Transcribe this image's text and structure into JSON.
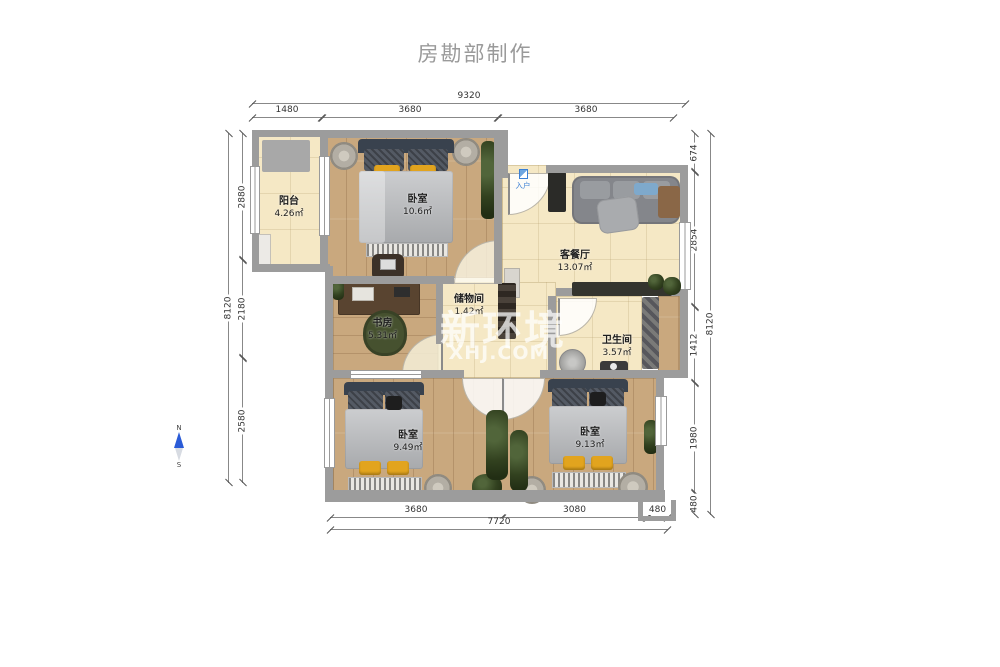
{
  "title": "房勘部制作",
  "watermark": {
    "brand": "新环境",
    "site": "XHJ.COM"
  },
  "compass": {
    "north": "N",
    "south": "S"
  },
  "entrance": {
    "label": "入户"
  },
  "rooms": [
    {
      "name": "阳台",
      "area": "4.26㎡"
    },
    {
      "name": "卧室",
      "area": "10.6㎡"
    },
    {
      "name": "客餐厅",
      "area": "13.07㎡"
    },
    {
      "name": "书房",
      "area": "5.31㎡"
    },
    {
      "name": "储物间",
      "area": "1.42㎡"
    },
    {
      "name": "卫生间",
      "area": "3.57㎡"
    },
    {
      "name": "卧室",
      "area": "9.49㎡"
    },
    {
      "name": "卧室",
      "area": "9.13㎡"
    }
  ],
  "dimensions": {
    "top": {
      "total": "9320",
      "segments": [
        "1480",
        "3680",
        "3680"
      ]
    },
    "bottom": {
      "total": "7720",
      "segments": [
        "3680",
        "3080",
        "480"
      ]
    },
    "left": {
      "total": "8120",
      "segments": [
        "2880",
        "2180",
        "2580"
      ]
    },
    "right": {
      "total": "8120",
      "segments": [
        "674",
        "2854",
        "1412",
        "1980",
        "480"
      ]
    }
  },
  "colors": {
    "wall": "#9c9c9c",
    "wood_floor": "#c9a87e",
    "tile_floor": "#f5e8c5",
    "accent_blue": "#3b7fd4",
    "bed_yellow": "#e2a41e",
    "title_gray": "#9a9a9a"
  }
}
